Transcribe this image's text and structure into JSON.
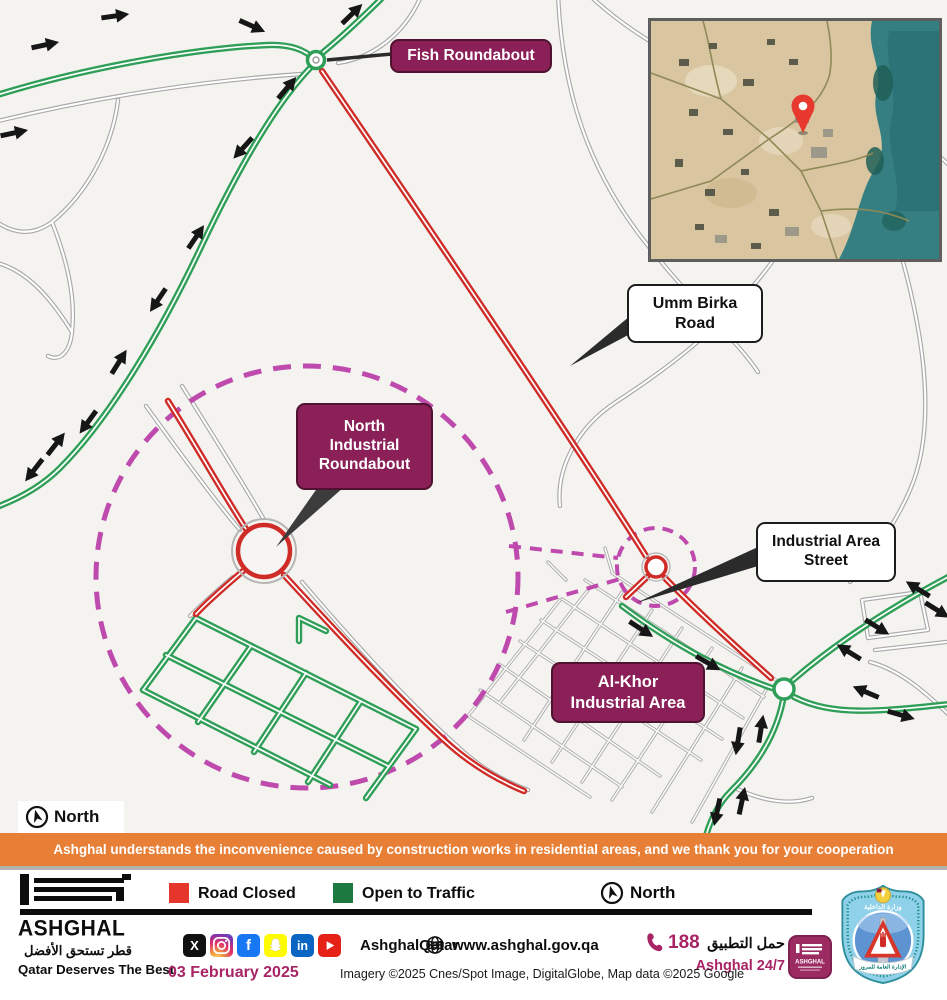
{
  "map": {
    "labels": {
      "fish": "Fish Roundabout",
      "umm_birka": "Umm Birka Road",
      "north_industrial": "North Industrial Roundabout",
      "industrial_area_street": "Industrial Area Street",
      "al_khor": "Al-Khor Industrial Area",
      "north": "North"
    },
    "colors": {
      "road_closed": "#cf2b27",
      "open_to_traffic": "#2f9e57",
      "zoom_highlight": "#bf4aad",
      "label_magenta": "#8a2057"
    }
  },
  "banner": {
    "text": "Ashghal understands the inconvenience caused by construction works in residential areas, and we thank you for your cooperation"
  },
  "footer": {
    "brand": {
      "name": "ASHGHAL",
      "tagline_ar": "قطر تستحق الأفضل",
      "tagline_en": "Qatar Deserves The Best"
    },
    "legend": [
      {
        "label": "Road Closed",
        "color": "#e6352b"
      },
      {
        "label": "Open to Traffic",
        "color": "#1c7a40"
      }
    ],
    "north": "North",
    "social": {
      "handle": "AshghalQatar",
      "x_glyph": "X",
      "facebook_glyph": "f",
      "linkedin_glyph": "in"
    },
    "website": "www.ashghal.gov.qa",
    "phone": "188",
    "app": {
      "label_ar": "حمل التطبيق",
      "label_en": "Ashghal 24/7"
    },
    "date": "03 February 2025",
    "credit": "Imagery ©2025 Cnes/Spot Image, DigitalGlobe, Map data ©2025 Google",
    "emblem": {
      "top_ar": "وزارة الداخلية",
      "ribbon_ar": "الإدارة العامة للمرور"
    }
  }
}
